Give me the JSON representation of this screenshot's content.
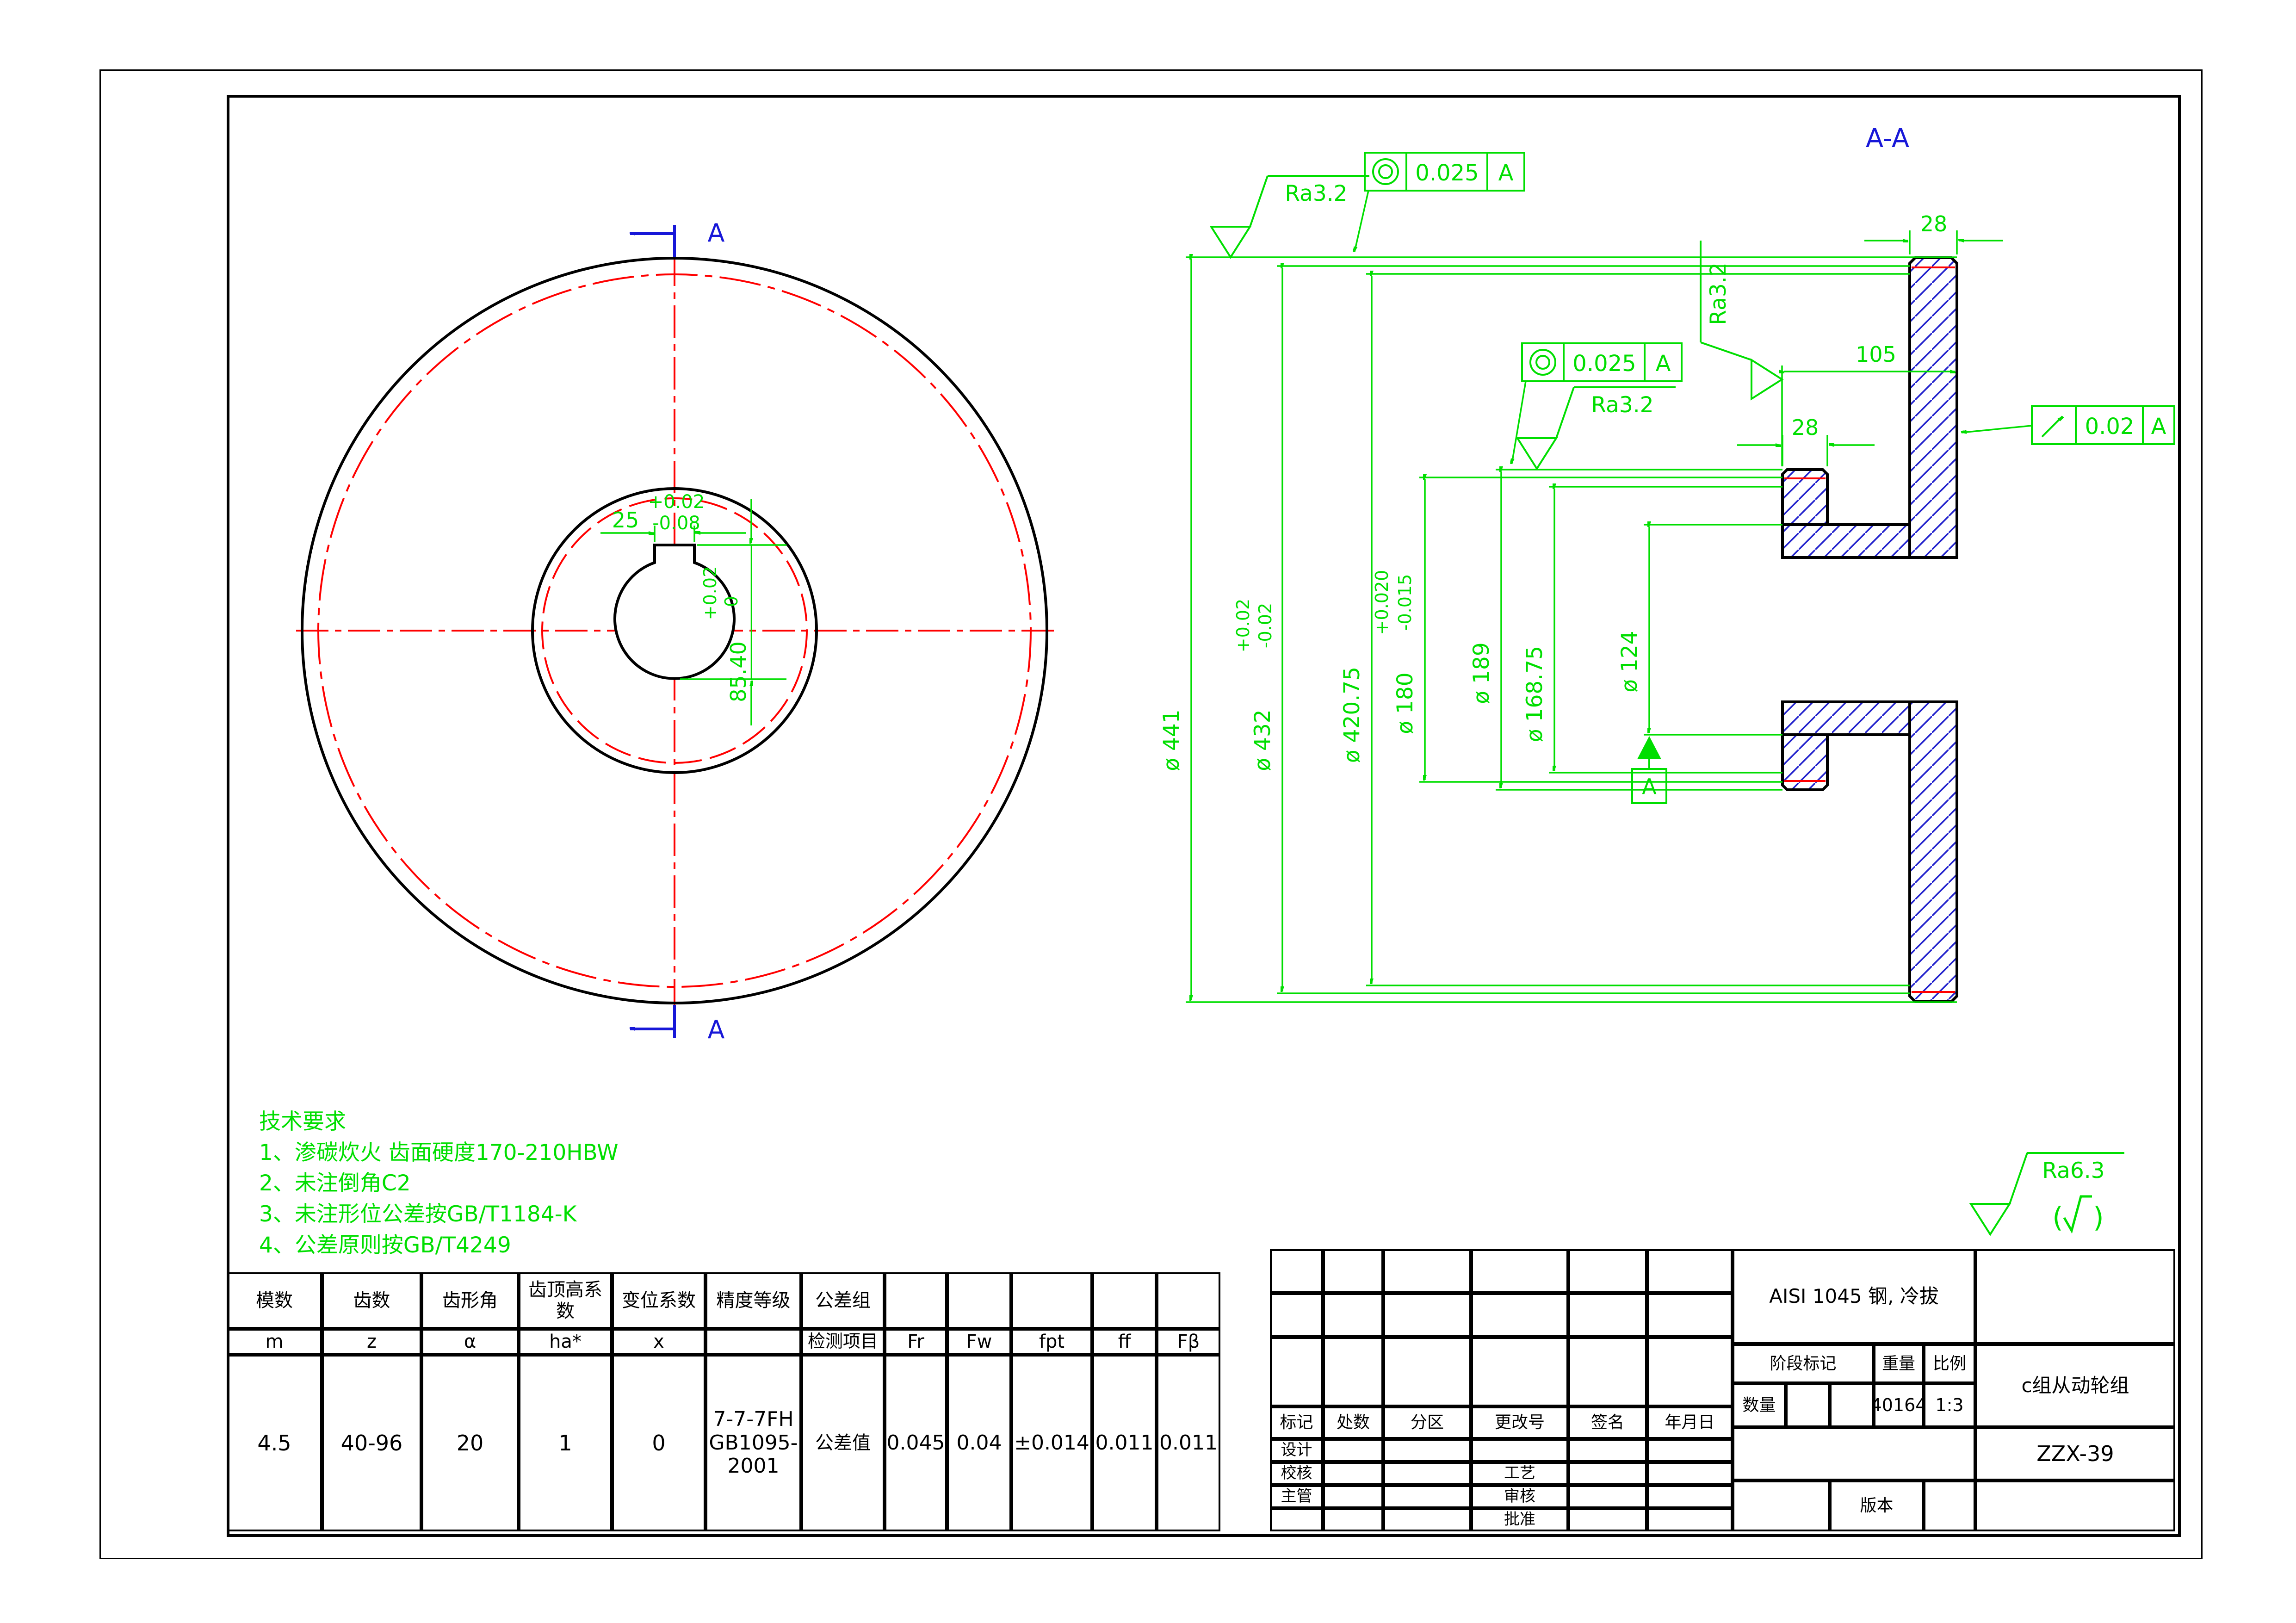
{
  "colors": {
    "green": "#00DE00",
    "red": "#FF0000",
    "blue": "#1717D8",
    "hatch": "#2222CC",
    "black": "#000000"
  },
  "section_view": {
    "title": "A-A",
    "dims": [
      {
        "label": "ø 441",
        "up": "",
        "dn": ""
      },
      {
        "label": "ø 432",
        "up": "+0.02",
        "dn": "-0.02"
      },
      {
        "label": "ø 420.75",
        "up": "",
        "dn": ""
      },
      {
        "label": "ø 180",
        "up": "+0.020",
        "dn": "-0.015"
      },
      {
        "label": "ø 189",
        "up": "",
        "dn": ""
      },
      {
        "label": "ø 168.75",
        "up": "",
        "dn": ""
      },
      {
        "label": "ø 124",
        "up": "",
        "dn": ""
      }
    ],
    "width_dims": {
      "rim": "28",
      "total": "105",
      "hub": "28"
    },
    "surface_mark": "Ra3.2",
    "tol_frames": [
      {
        "symbol": "concentricity",
        "value": "0.025",
        "datum": "A"
      },
      {
        "symbol": "concentricity",
        "value": "0.025",
        "datum": "A"
      },
      {
        "symbol": "circular-runout",
        "value": "0.02",
        "datum": "A"
      }
    ],
    "datum_label": "A"
  },
  "front_view": {
    "section_label": "A",
    "keyway_width": {
      "value": "25",
      "up": "+0.02",
      "dn": "-0.08"
    },
    "keyway_depth": {
      "value": "85.40",
      "up": "+0.02",
      "dn": "0"
    }
  },
  "surface_note": {
    "value": "Ra6.3",
    "paren_open": "(",
    "paren_close": ")"
  },
  "tech_requirements": {
    "title": "技术要求",
    "items": [
      "1、渗碳炊火 齿面硬度170-210HBW",
      "2、未注倒角C2",
      "3、未注形位公差按GB/T1184-K",
      "4、公差原则按GB/T4249"
    ]
  },
  "gear_table": {
    "headers": [
      "模数",
      "齿数",
      "齿形角",
      "齿顶高系数",
      "变位系数",
      "精度等级",
      "公差组"
    ],
    "symbols": [
      "m",
      "z",
      "α",
      "ha*",
      "x",
      "检测项目",
      "Fr",
      "Fw",
      "fpt",
      "ff",
      "Fβ"
    ],
    "values": [
      "4.5",
      "40-96",
      "20",
      "1",
      "0",
      "7-7-7FH\nGB1095-\n2001",
      "公差值",
      "0.045",
      "0.04",
      "±0.014",
      "0.011",
      "0.011"
    ]
  },
  "title_block": {
    "material": "AISI 1045 钢, 冷拔",
    "part_name": "c组从动轮组",
    "drawing_no": "ZZX-39",
    "stage_label": "阶段标记",
    "weight_label": "重量",
    "scale_label": "比例",
    "qty_label": "数量",
    "weight_value": "40164",
    "scale_value": "1:3",
    "version_label": "版本",
    "rev_headers": [
      "标记",
      "处数",
      "分区",
      "更改号",
      "签名",
      "年月日"
    ],
    "sign_labels": [
      "设计",
      "校核",
      "主管"
    ],
    "process_labels": [
      "工艺",
      "审核",
      "批准"
    ]
  }
}
